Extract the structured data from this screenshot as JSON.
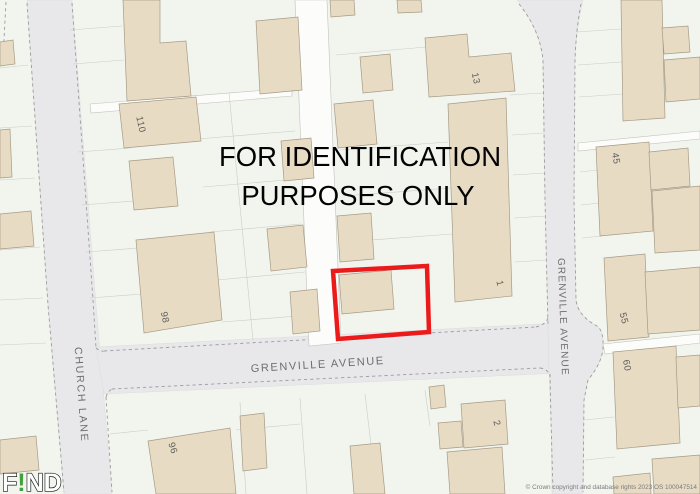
{
  "title_overlay": {
    "line1": "FOR IDENTIFICATION",
    "line2": "PURPOSES ONLY"
  },
  "streets": {
    "church_lane": "CHURCH LANE",
    "grenville_avenue_horizontal": "GRENVILLE AVENUE",
    "grenville_avenue_vertical": "GRENVILLE AVENUE"
  },
  "house_numbers": [
    "110",
    "98",
    "96",
    "13",
    "1",
    "2",
    "45",
    "55",
    "60"
  ],
  "logo": {
    "f": "F",
    "bang": "!",
    "nd": "ND"
  },
  "attribution": "© Crown copyright and database rights 2023 OS 100047514",
  "colors": {
    "selection_red": "#ec1b1b",
    "building_beige": "#e8dbc3",
    "road_gray": "#e8e8eb",
    "plot_background": "#f1f5ee",
    "logo_green": "#42a13c",
    "label_gray": "#6e6e6e"
  }
}
